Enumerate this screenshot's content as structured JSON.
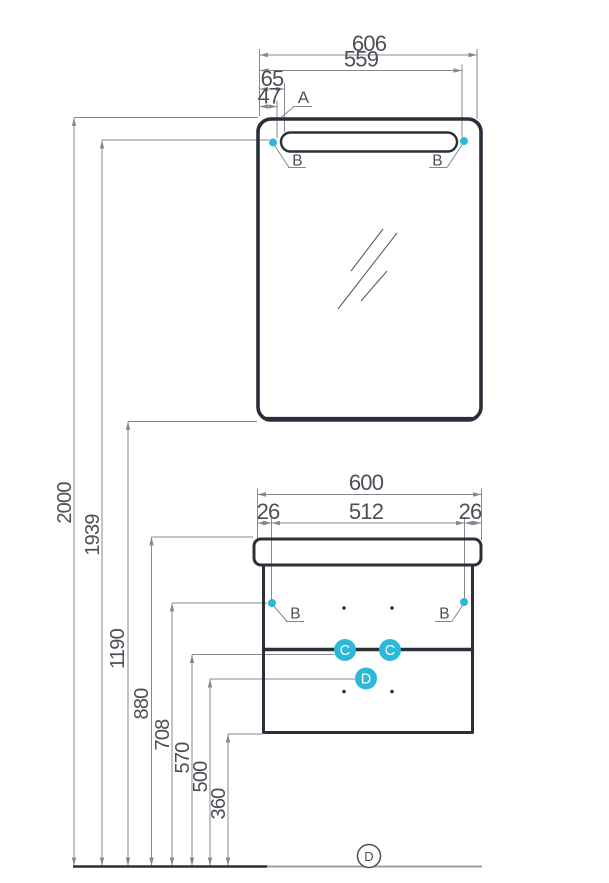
{
  "dims": {
    "top": [
      "606",
      "559",
      "65",
      "47"
    ],
    "bottom": [
      "600",
      "26",
      "512",
      "26"
    ],
    "left": [
      "2000",
      "1939",
      "1190",
      "880",
      "708",
      "570",
      "500",
      "360"
    ]
  },
  "callouts": {
    "a": "A",
    "b": "B",
    "c": "C",
    "d": "D"
  },
  "floor": {
    "marker": "D"
  },
  "colors": {
    "accent": "#2cb9d8",
    "furniture": "#2b3038",
    "dim": "#85898e",
    "text": "#4b5057",
    "floor": "#9aa0a4"
  }
}
